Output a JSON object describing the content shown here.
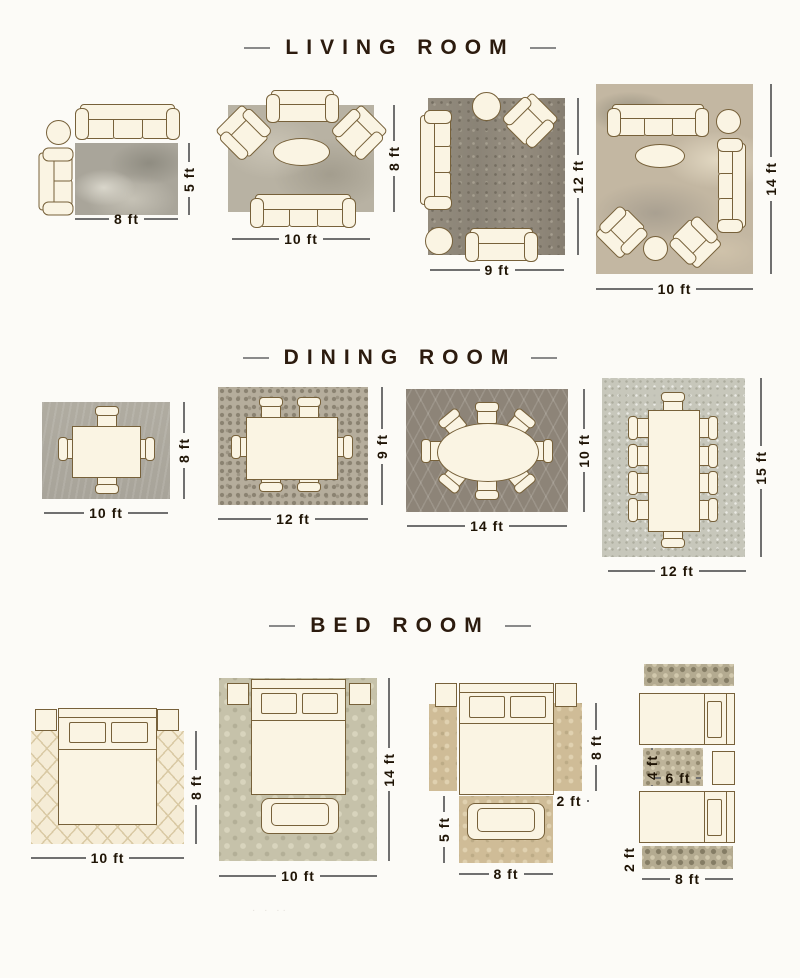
{
  "page": {
    "background": "#fcfbf7",
    "watermark_dots": "· · ··"
  },
  "colors": {
    "title_text": "#2c1b0e",
    "header_dash": "#8a8a8a",
    "dimension_text": "#1f1405",
    "dimension_line": "#707070",
    "furniture_fill": "#faf4e3",
    "furniture_outline": "#77613a"
  },
  "sections": [
    {
      "title": "LIVING ROOM",
      "layouts": [
        {
          "width_label": "8 ft",
          "height_label": "5 ft"
        },
        {
          "width_label": "10 ft",
          "height_label": "8 ft"
        },
        {
          "width_label": "9 ft",
          "height_label": "12 ft"
        },
        {
          "width_label": "10 ft",
          "height_label": "14 ft"
        }
      ]
    },
    {
      "title": "DINING ROOM",
      "layouts": [
        {
          "width_label": "10 ft",
          "height_label": "8 ft"
        },
        {
          "width_label": "12 ft",
          "height_label": "9 ft"
        },
        {
          "width_label": "14 ft",
          "height_label": "10 ft"
        },
        {
          "width_label": "12 ft",
          "height_label": "15 ft"
        }
      ]
    },
    {
      "title": "BED ROOM",
      "layouts": [
        {
          "width_label": "10 ft",
          "height_label": "8 ft"
        },
        {
          "width_label": "10 ft",
          "height_label": "14 ft"
        },
        {
          "side_runner_height_label": "8 ft",
          "side_runner_width_label": "2 ft",
          "foot_rug_height_label": "5 ft",
          "foot_rug_width_label": "8 ft"
        },
        {
          "between_rug_height_label": "4 ft",
          "between_rug_width_label": "6 ft",
          "runner_height_label": "2 ft",
          "runner_width_label": "8 ft"
        }
      ]
    }
  ]
}
